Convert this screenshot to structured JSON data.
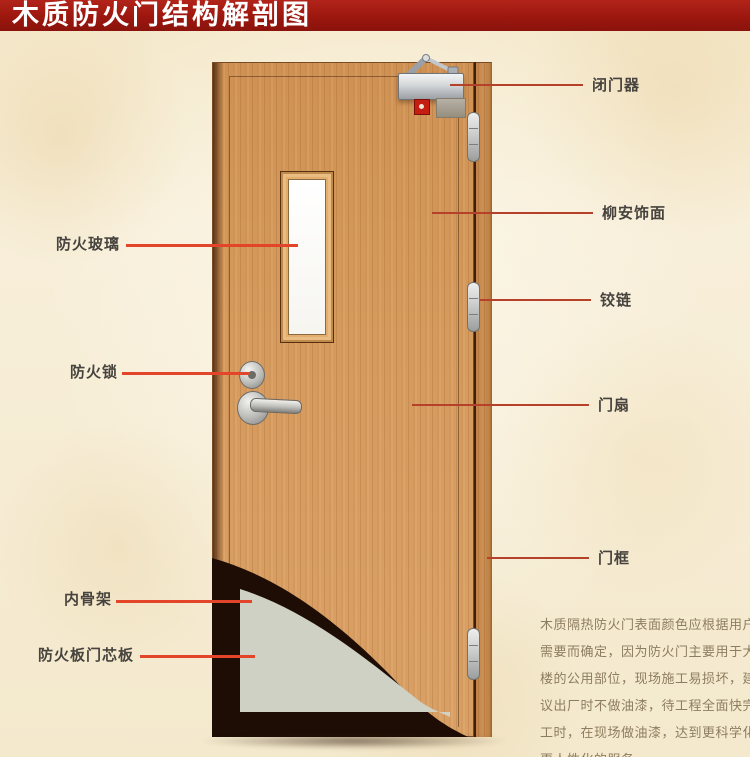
{
  "title": "木质防火门结构解剖图",
  "annotations": {
    "left": [
      {
        "label": "防火玻璃"
      },
      {
        "label": "防火锁"
      },
      {
        "label": "内骨架"
      },
      {
        "label": "防火板门芯板"
      }
    ],
    "right": [
      {
        "label": "闭门器"
      },
      {
        "label": "柳安饰面"
      },
      {
        "label": "铰链"
      },
      {
        "label": "门扇"
      },
      {
        "label": "门框"
      }
    ]
  },
  "description": {
    "lines": [
      "木质隔热防火门表面颜色应根据用户",
      "需要而确定，因为防火门主要用于大",
      "楼的公用部位，现场施工易损坏，建",
      "议出厂时不做油漆，待工程全面快完",
      "工时，在现场做油漆，达到更科学化",
      "更人性化的服务。"
    ]
  },
  "colors": {
    "banner": "#9c170e",
    "leader_line": "#b5412a",
    "leader_line_bright": "#e2452a",
    "wood": "#d09457",
    "core_panel": "#ced1c4",
    "inner_frame": "#1e0d05",
    "label_text": "#47433e",
    "description_text": "#8d7d60",
    "background": "#f6ecd2"
  }
}
